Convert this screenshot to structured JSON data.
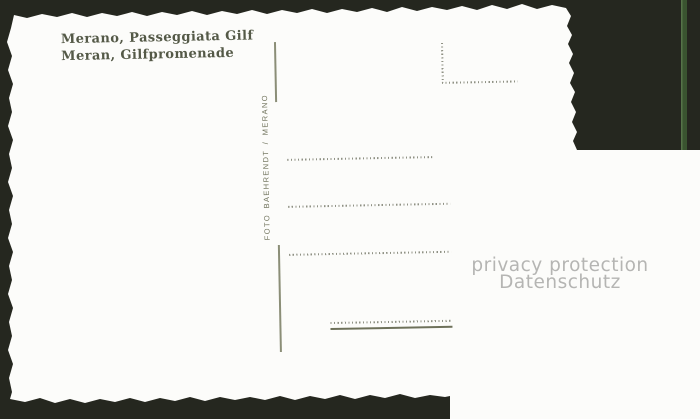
{
  "postcard": {
    "caption": {
      "line1": "Merano, Passeggiata Gilf",
      "line2": "Meran, Gilfpromenade"
    },
    "publisher": "FOTO BAEHRENDT / MERANO",
    "watermark": {
      "line1": "privacy protection",
      "line2": "Datenschutz"
    }
  },
  "colors": {
    "background_dark": "#25271f",
    "green_strip": "#3a5430",
    "green_strip_edge": "#567349",
    "card_white": "#fcfcfa",
    "caption_text": "#545947",
    "publisher_text": "#70735c",
    "rule_line": "#8b8e77",
    "dotted_line": "#8f9184",
    "underline": "#6e715a",
    "watermark_text": "#b5b5b3"
  }
}
